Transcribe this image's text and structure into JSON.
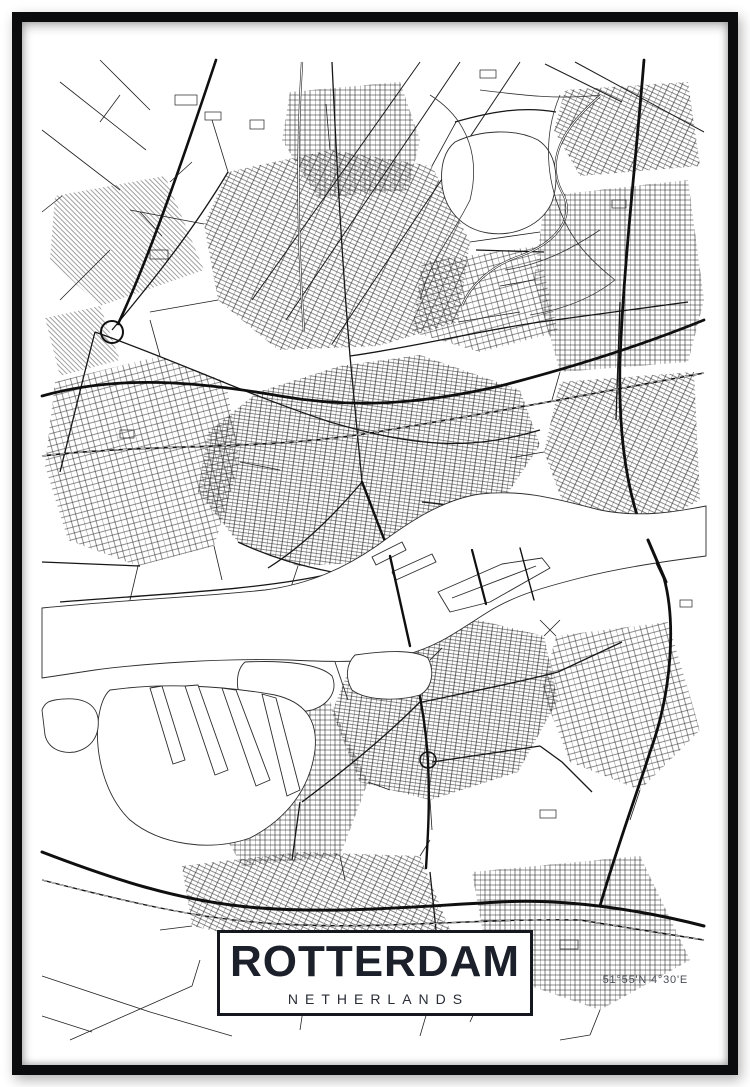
{
  "poster": {
    "title": "ROTTERDAM",
    "subtitle": "NETHERLANDS",
    "coordinates": "51°55'N 4°30'E"
  },
  "colors": {
    "paper_white": "#ffffff",
    "frame_black": "#0b0c0e",
    "title_ink": "#1c202a",
    "road_ink": "#1a1a1a",
    "coordinates_gray": "#4a4e57",
    "water_outline": "#2d2d2d"
  }
}
